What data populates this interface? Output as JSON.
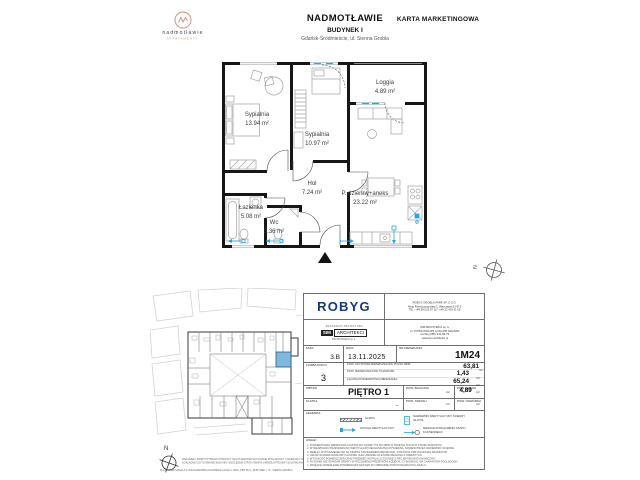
{
  "header": {
    "logo": {
      "brand": "nadmotławie",
      "sub": "APARTAMENTY"
    },
    "title": "NADMOTŁAWIE",
    "subtitle": "BUDYNEK I",
    "address": "Gdańsk-Śródmieście, ul. Sienna Grobla",
    "doc_type": "KARTA MARKETINGOWA"
  },
  "plan": {
    "north_label": "N",
    "rooms": [
      {
        "name": "Sypialnia",
        "area": "13.94 m²"
      },
      {
        "name": "Sypialnia",
        "area": "10.97 m²"
      },
      {
        "name": "Loggia",
        "area": "4.89 m²"
      },
      {
        "name": "Hol",
        "area": "7.24 m²"
      },
      {
        "name": "P. dzienny+aneks",
        "area": "23.22 m²"
      },
      {
        "name": "Łazienka",
        "area": "5.08 m²"
      },
      {
        "name": "Wc",
        "area": "3.36 m²"
      }
    ]
  },
  "keyplan": {
    "north_label": "N",
    "note_line1": "KIERUNEK I ZWROT STRZAŁKI PÓŁNOCY MA CHARAKTER WYŁĄCZNIE POGLĄDOWY I ORIENTACYJNY",
    "note_line2": "DOKŁADNE USYTUOWANIE BUDYNKU WZGLĘDEM STRON ŚWIATA OKREŚLA PROJEKT BUDOWLANY",
    "caption": "PLAN KONDYGNACJI Z OZNACZENIEM POŁOŻENIA LOKALU 1M24, PIĘTRO 1, BUDYNEK I, UL. SIENNA GROBLA"
  },
  "table": {
    "developer": {
      "logo": "ROBYG",
      "line1": "ROBYG GROBLA PARK SP. Z O.O.",
      "line2": "Aleja Rzeczypospolitej 1, Warszawa 02-972",
      "line3": "TEL. +48 58 022 07 10 / +48 22 419 11 05"
    },
    "architect": {
      "logo_top": "PRACOWNIA PROJEKTOWA",
      "logo_main": "SIM",
      "logo_main2": "ARCHITEKCI",
      "line1": "SIM ARCHITEKCI sp. k.",
      "line2": "ul. TOPOLOWA 8/9 L2 80-255 GDAŃSK",
      "line3": "tel./fax (058) 341-09-73",
      "line4": "www.sim-architekci.pl"
    },
    "faza": {
      "label": "FAZA",
      "value": "3.B"
    },
    "data": {
      "label": "DATA",
      "value": "13.11.2025"
    },
    "nr": {
      "label": "NR MIESZKANIA",
      "value": "1M24"
    },
    "pokoje": {
      "label": "LICZBA POKOI",
      "value": "3"
    },
    "areas": [
      {
        "label": "POW. UŻYTKOWA MIESZKANIA WG PN-ISO 9836:",
        "value": "63,81",
        "unit": "m²"
      },
      {
        "label": "POW. MIESZKANIA POD ŚCIANKAMI:",
        "value": "1,43",
        "unit": "m²"
      },
      {
        "label": "ŁĄCZNA POWIERZCHNIA MIESZKANIA:",
        "value": "65,24",
        "unit": "m²"
      }
    ],
    "pietro": {
      "label": "PIĘTRO",
      "value": "PIĘTRO 1"
    },
    "balkon": {
      "label": "POW. BALKONU",
      "value": "",
      "unit": "m²"
    },
    "loggia": {
      "label": "POW. LOGGII",
      "value": "4,89",
      "unit": "m²"
    },
    "klatka": {
      "label": "KLATKA",
      "value": "-"
    },
    "taras": {
      "label": "POW. TARASU",
      "value": "",
      "unit": "m²"
    },
    "ogrodek": {
      "label": "POW. OGRÓDKA",
      "value": "",
      "unit": "m²"
    },
    "legend": {
      "label": "LEGENDA",
      "items": [
        {
          "name": "ŚCIANY"
        },
        {
          "name": "WYCIĄG WENTYLACYJNY"
        },
        {
          "name": "NAWIEWNIK WENTYLACYJNY ŚCIENNY",
          "name2": "GŁ.POŚ."
        },
        {
          "name": "MIEJSCE PODŁĄCZENIA OKAPU",
          "name2": "KUCHENNEGO"
        }
      ]
    },
    "uwagi": {
      "label": "UWAGI:",
      "lines": [
        "1. POWIERZCHNIA MIESZKANIA LICZONA WG NORMY PN-ISO 9836 W ŚWIETLE ŚCIAN W STANIE SUROWYM.",
        "2. W MIESZKANIU PRZEWIDZIANO WENTYLACJĘ MECHANICZNĄ WYWIEWNĄ, NAWIEW PRZEZ NAWIEWNIKI ŚCIENNE.",
        "3. MEBLE I WYPOSAŻENIE NIE SĄ OBJĘTE STANDARDEM MIESZKANIA, STANOWIĄ PRZYKŁADOWĄ ARANŻACJĘ.",
        "4. UKŁAD ŚCIANEK DZIAŁOWYCH MOŻE ULEC ZMIANIE NA ETAPIE REALIZACJI INWESTYCJI.",
        "5. WYSOKOŚĆ POMIESZCZEŃ ORAZ PRZEBIEG INSTALACJI ZGODNE Z PROJEKTEM WYKONAWCZYM.",
        "6. RYSUNEK NIE STANOWI OFERTY W ROZUMIENIU PRZEPISÓW KODEKSU CYWILNEGO, MA CHARAKTER POGLĄDOWY.",
        "7. WIĄŻĄCE OKREŚLENIE POWIERZCHNI NASTĄPI PO OBMIARZE POWYKONAWCZYM LOKALU."
      ]
    }
  },
  "colors": {
    "accent_blue": "#29a8e0",
    "highlight_unit": "#7fb8dc",
    "logo_salmon": "#cf8872",
    "robyg_navy": "#16387c"
  }
}
